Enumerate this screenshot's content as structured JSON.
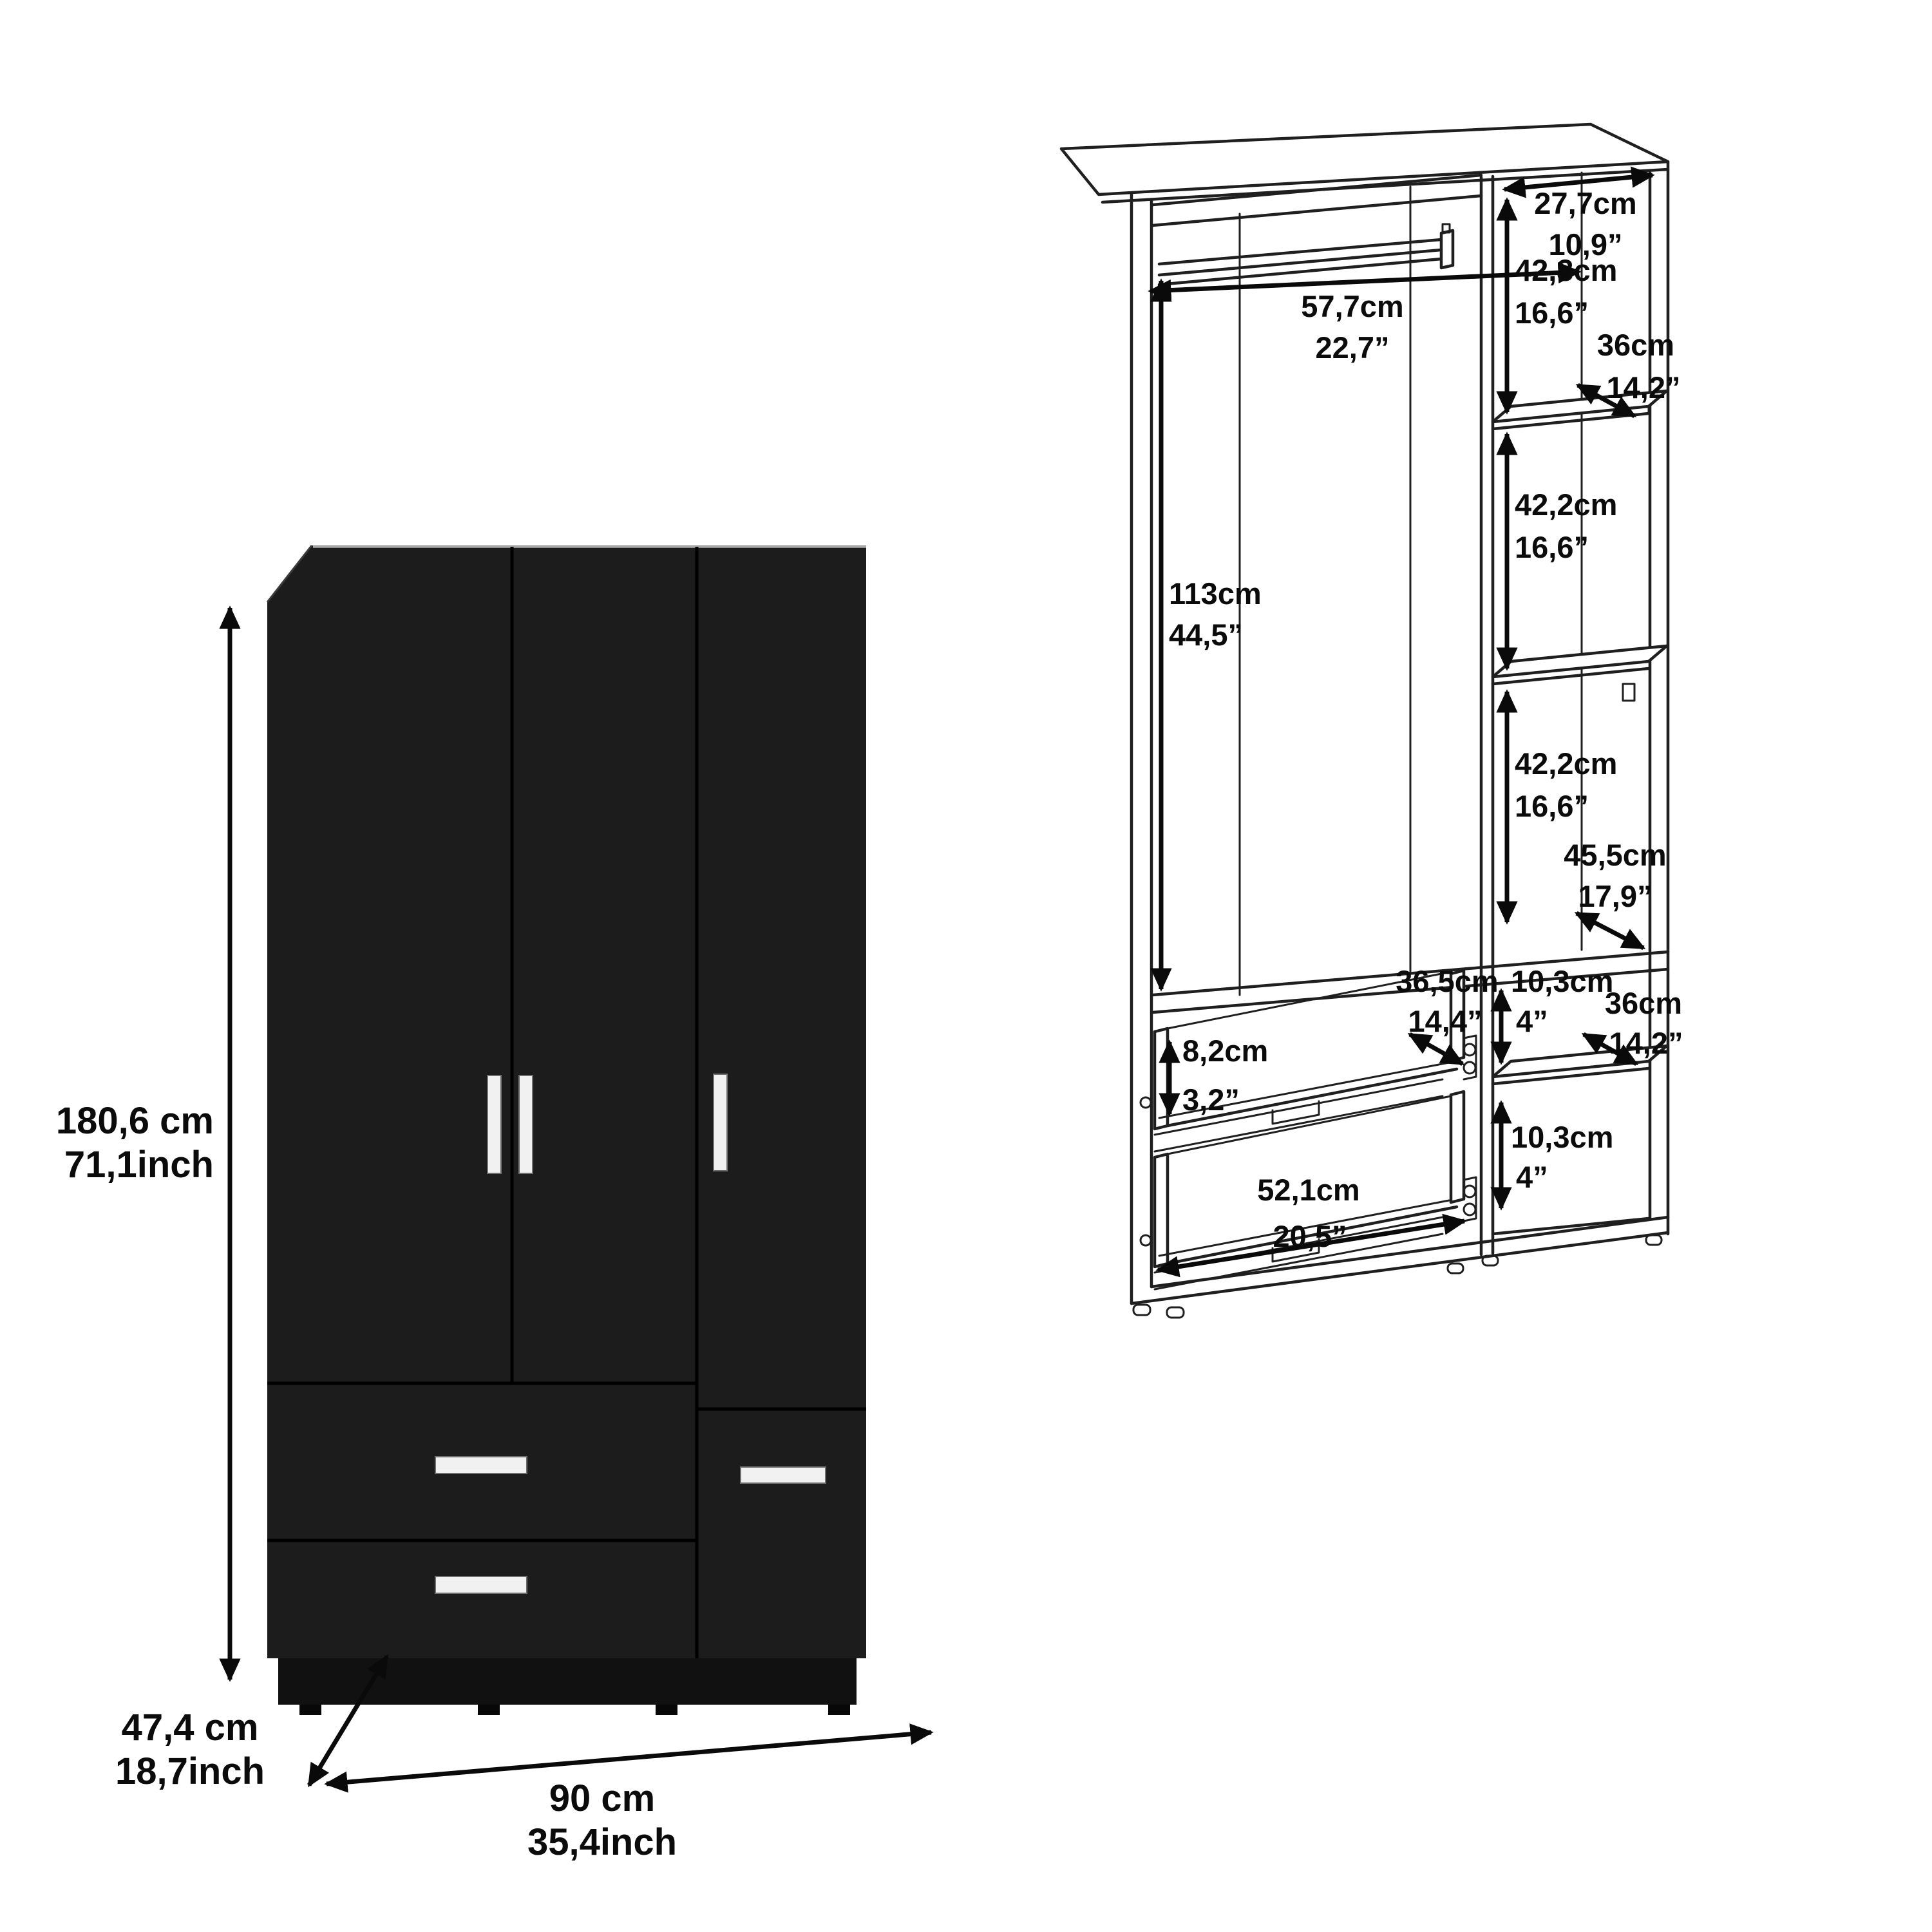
{
  "page": {
    "background": "#ffffff"
  },
  "product_front": {
    "height_cm": "180,6 cm",
    "height_inch": "71,1inch",
    "depth_cm": "47,4 cm",
    "depth_inch": "18,7inch",
    "width_cm": "90 cm",
    "width_inch": "35,4inch",
    "colors": {
      "body": "#1c1c1c",
      "plinth": "#111111",
      "handle": "#f1f1f1",
      "top_edge": "#a8a8a8"
    }
  },
  "interior_diagram": {
    "annotations": {
      "rod_clearance": {
        "cm": "57,7cm",
        "inch": "22,7”"
      },
      "hanging_height": {
        "cm": "113cm",
        "inch": "44,5”"
      },
      "top_shelf_width": {
        "cm": "27,7cm",
        "inch": "10,9”"
      },
      "shelf_gap_top": {
        "cm": "42,3cm",
        "inch": "16,6”"
      },
      "shelf_depth_upper": {
        "cm": "36cm",
        "inch": "14,2”"
      },
      "shelf_gap_mid": {
        "cm": "42,2cm",
        "inch": "16,6”"
      },
      "shelf_gap_lower": {
        "cm": "42,2cm",
        "inch": "16,6”"
      },
      "base_depth": {
        "cm": "45,5cm",
        "inch": "17,9”"
      },
      "drawer_depth": {
        "cm": "36,5cm",
        "inch": "14,4”"
      },
      "niche_upper": {
        "cm": "10,3cm",
        "inch": "4”"
      },
      "shelf_depth_lower": {
        "cm": "36cm",
        "inch": "14,2”"
      },
      "drawer_side_height": {
        "cm": "8,2cm",
        "inch": "3,2”"
      },
      "drawer_width": {
        "cm": "52,1cm",
        "inch": "20,5”"
      },
      "niche_lower": {
        "cm": "10,3cm",
        "inch": "4”"
      }
    }
  }
}
